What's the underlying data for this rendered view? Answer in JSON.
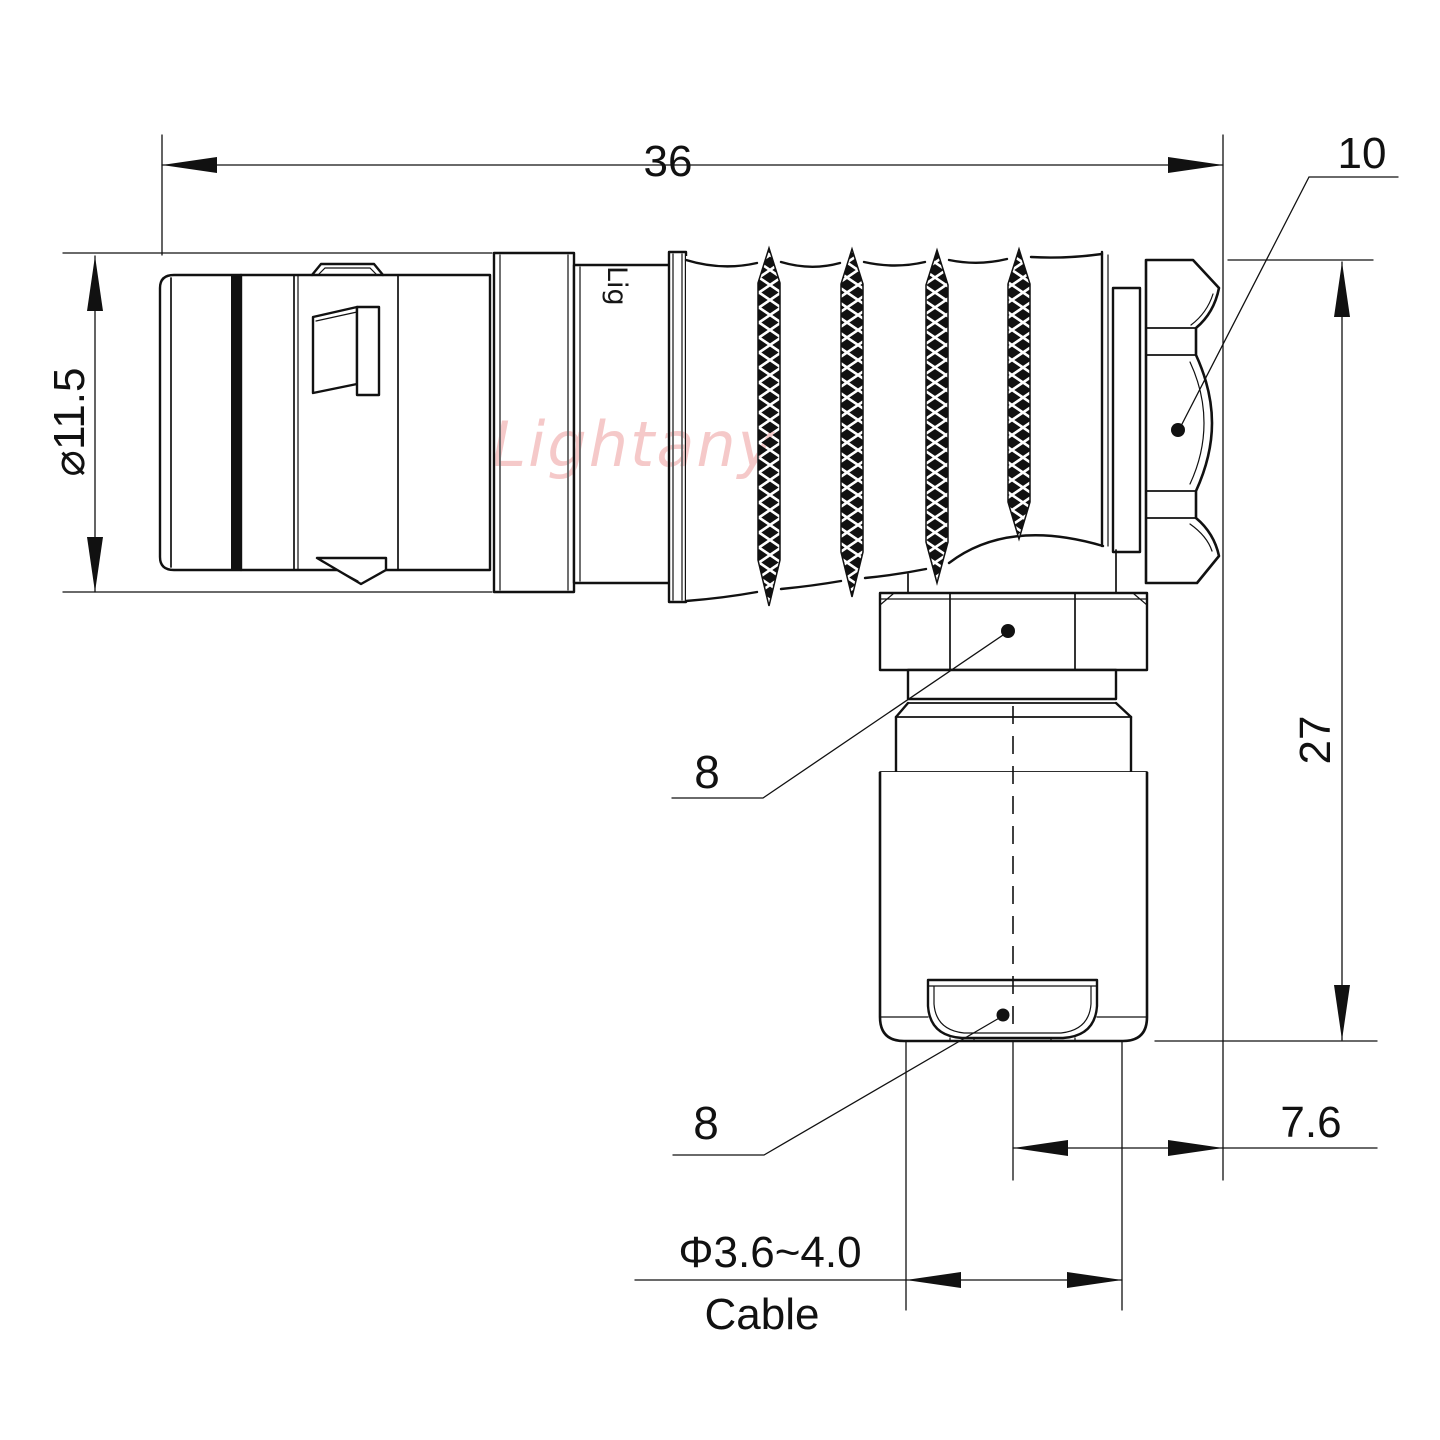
{
  "drawing": {
    "watermark": "Lightany",
    "body_engraving": "Lig",
    "colors": {
      "line": "#111111",
      "watermark_pink": "#f5c6c6",
      "background": "#ffffff"
    },
    "dimensions": {
      "overall_length": "36",
      "coupling_nut_callout": "10",
      "front_diameter": "⌀11.5",
      "height": "27",
      "backnut_hex_callout": "8",
      "cable_nut_hex_callout": "8",
      "axis_to_face": "7.6",
      "cable_diameter_range": "Φ3.6~4.0",
      "cable_label": "Cable"
    }
  }
}
